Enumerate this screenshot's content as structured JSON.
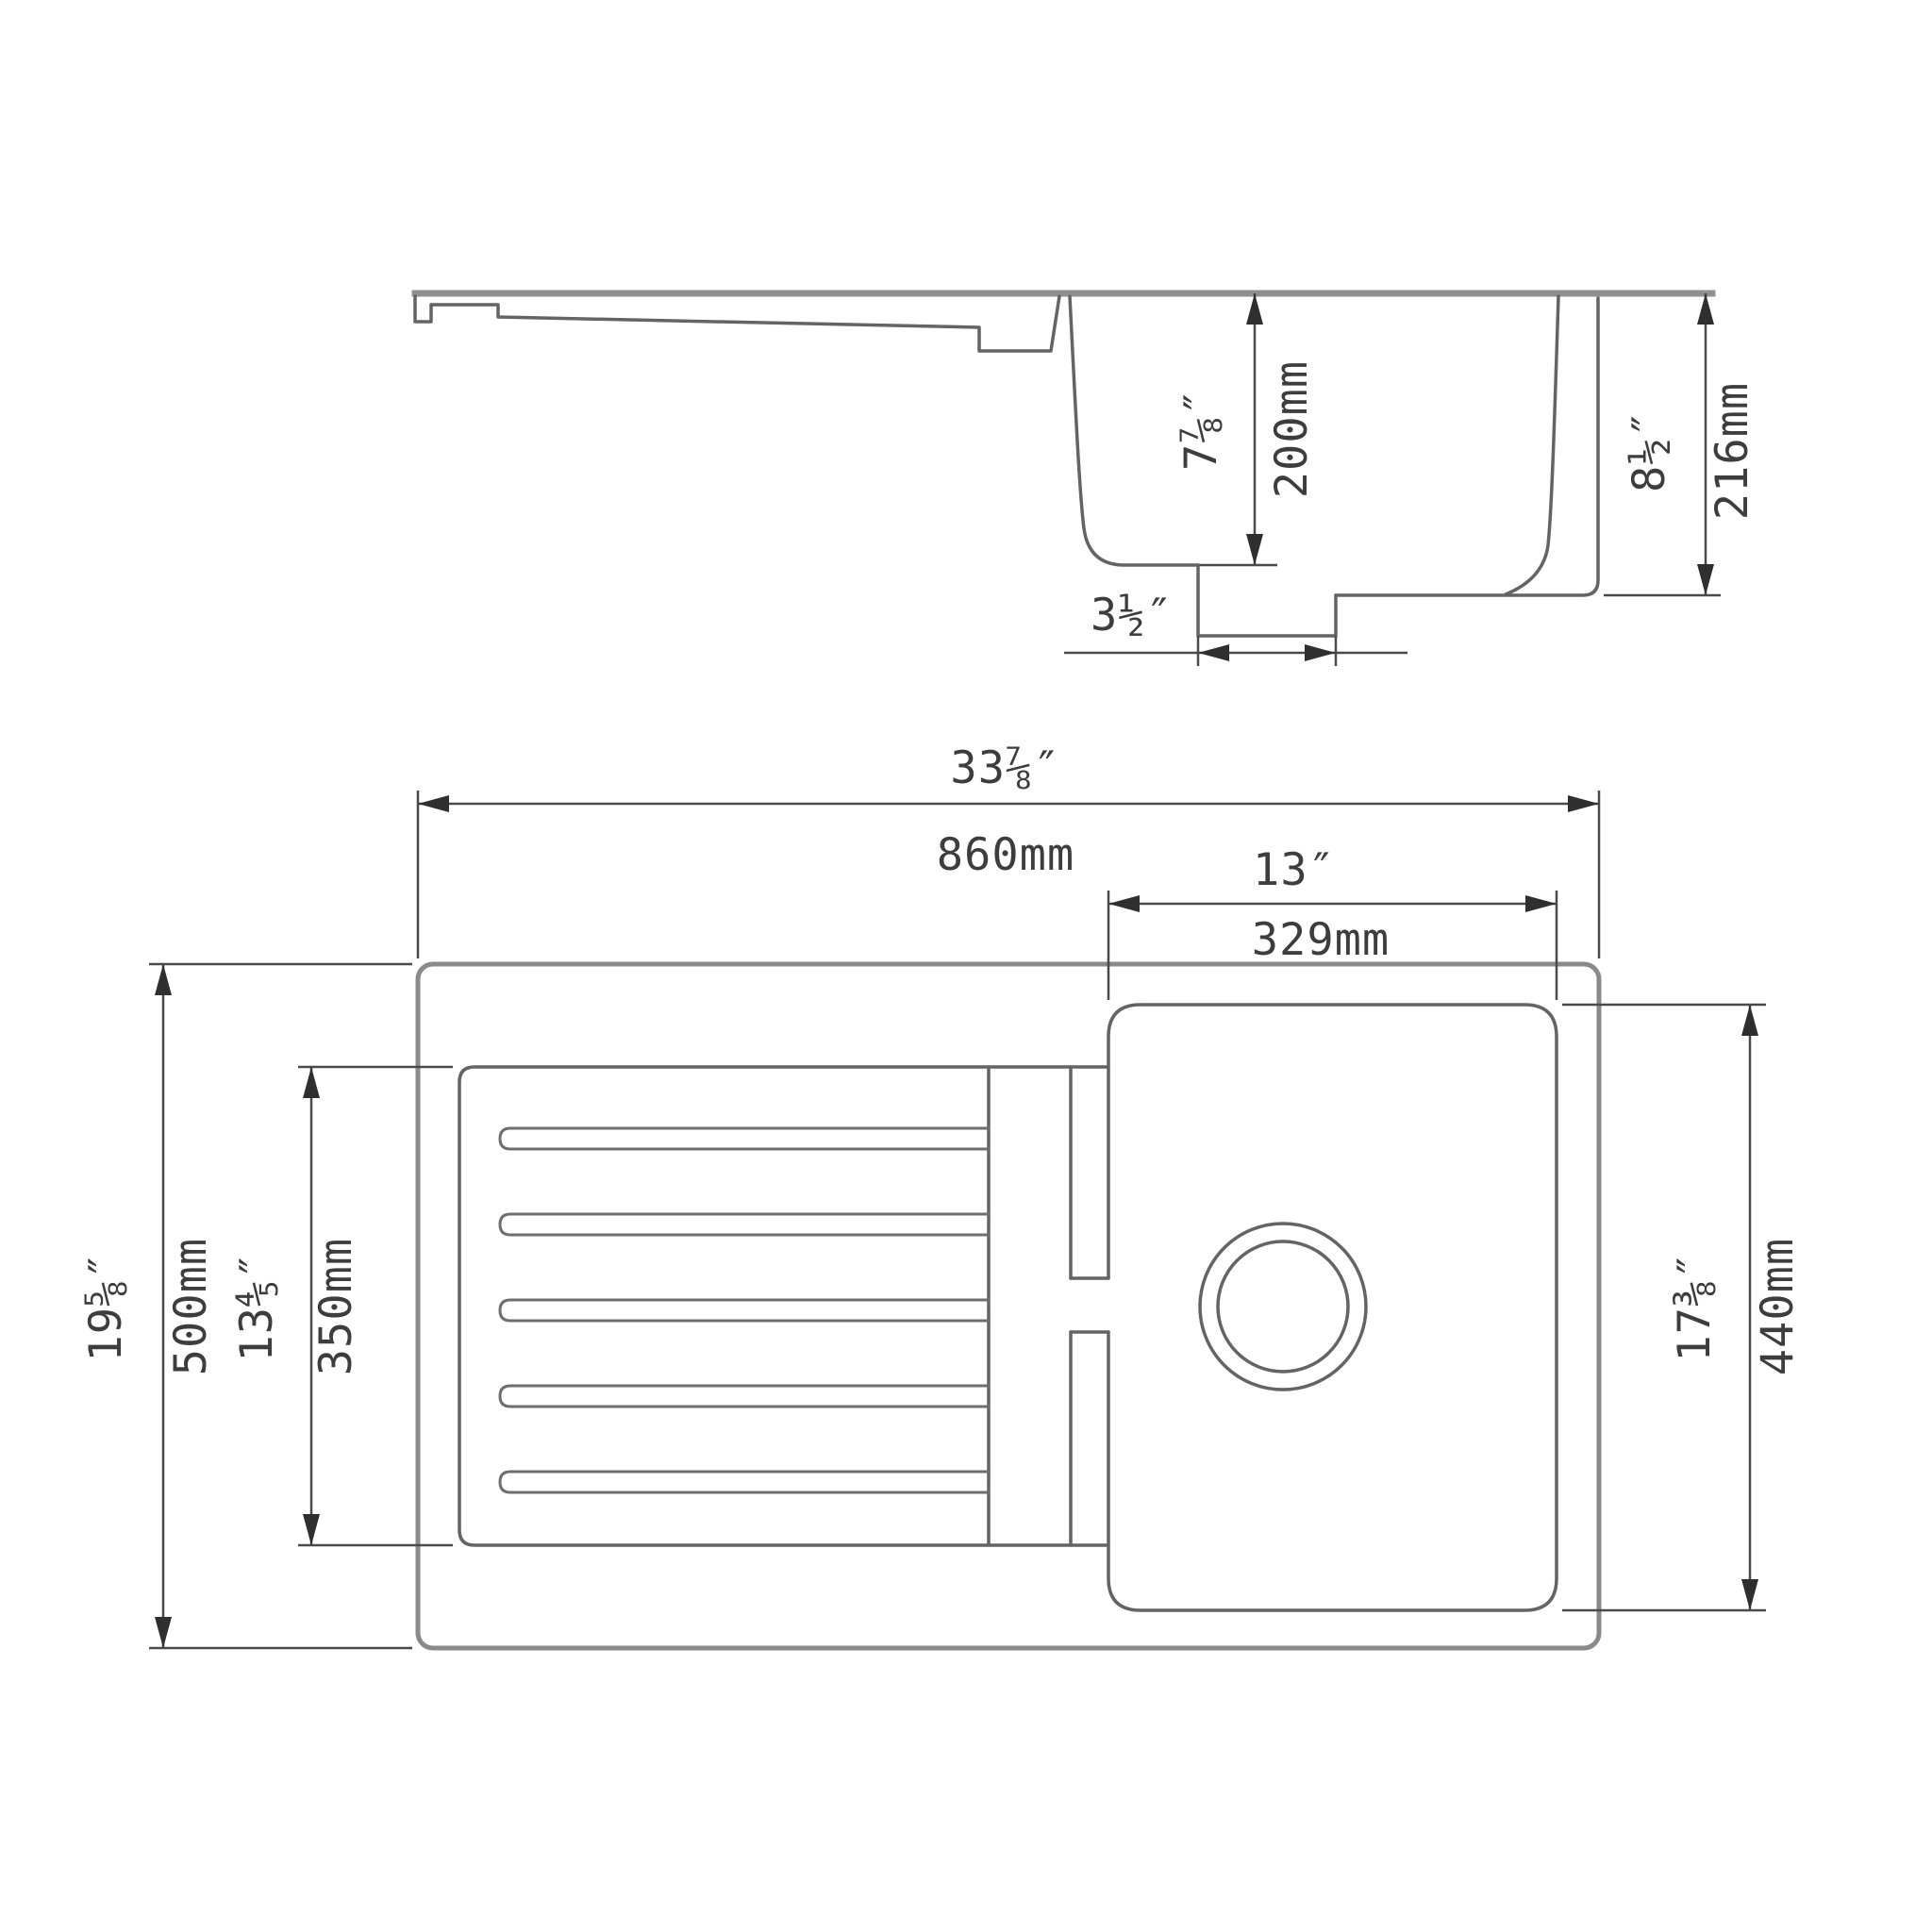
{
  "drawing": {
    "type": "kitchen sink dimension drawing",
    "colors": {
      "background": "#ffffff",
      "outline_heavy": "#8f8f8f",
      "outline": "#646464",
      "dimension_lines": "#4a4a4a",
      "text": "#3d3d3d"
    },
    "side_view": {
      "dims": {
        "bowl_depth": {
          "inches": "7⅞″",
          "mm": "200mm"
        },
        "overall_height": {
          "inches": "8½″",
          "mm": "216mm"
        },
        "drain_outlet": {
          "inches": "3½″",
          "mm": "ø91mm"
        }
      }
    },
    "plan_view": {
      "dims": {
        "overall_width": {
          "inches": "33⅞″",
          "mm": "860mm"
        },
        "bowl_width": {
          "inches": "13″",
          "mm": "329mm"
        },
        "overall_depth": {
          "inches": "19⅝″",
          "mm": "500mm"
        },
        "drainboard_depth": {
          "inches": "13⅘″",
          "mm": "350mm"
        },
        "bowl_length": {
          "inches": "17⅜″",
          "mm": "440mm"
        }
      }
    }
  }
}
